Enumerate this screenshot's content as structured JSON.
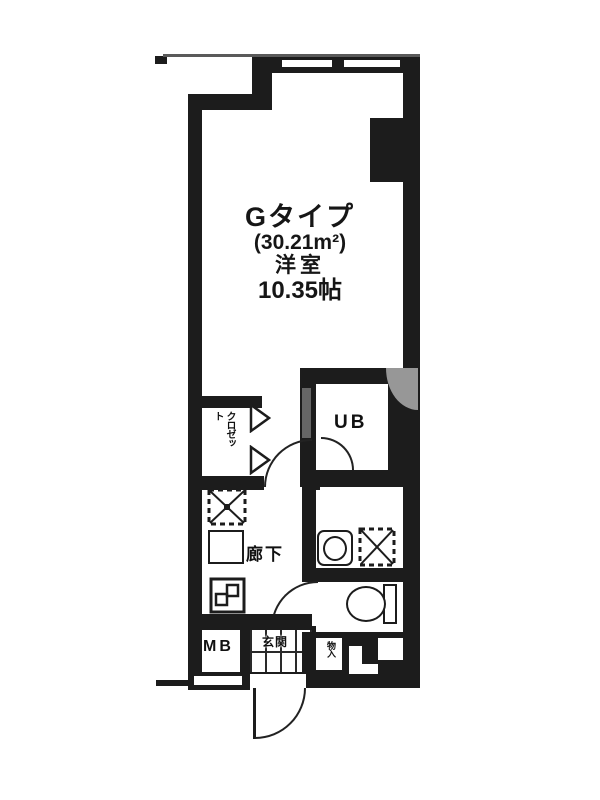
{
  "floorplan": {
    "unit_type": "Gタイプ",
    "unit_area": "(30.21m²)",
    "room_name": "洋室",
    "room_size": "10.35帖",
    "labels": {
      "unit_bath": "UB",
      "hallway": "廊下",
      "meter_box": "MB",
      "entrance": "玄関",
      "closet": "クロゼット",
      "storage": "物入"
    },
    "colors": {
      "wall": "#1c1c1c",
      "background": "#ffffff",
      "thin_line": "#5a5a5a",
      "artifact_gray": "#979797"
    }
  }
}
